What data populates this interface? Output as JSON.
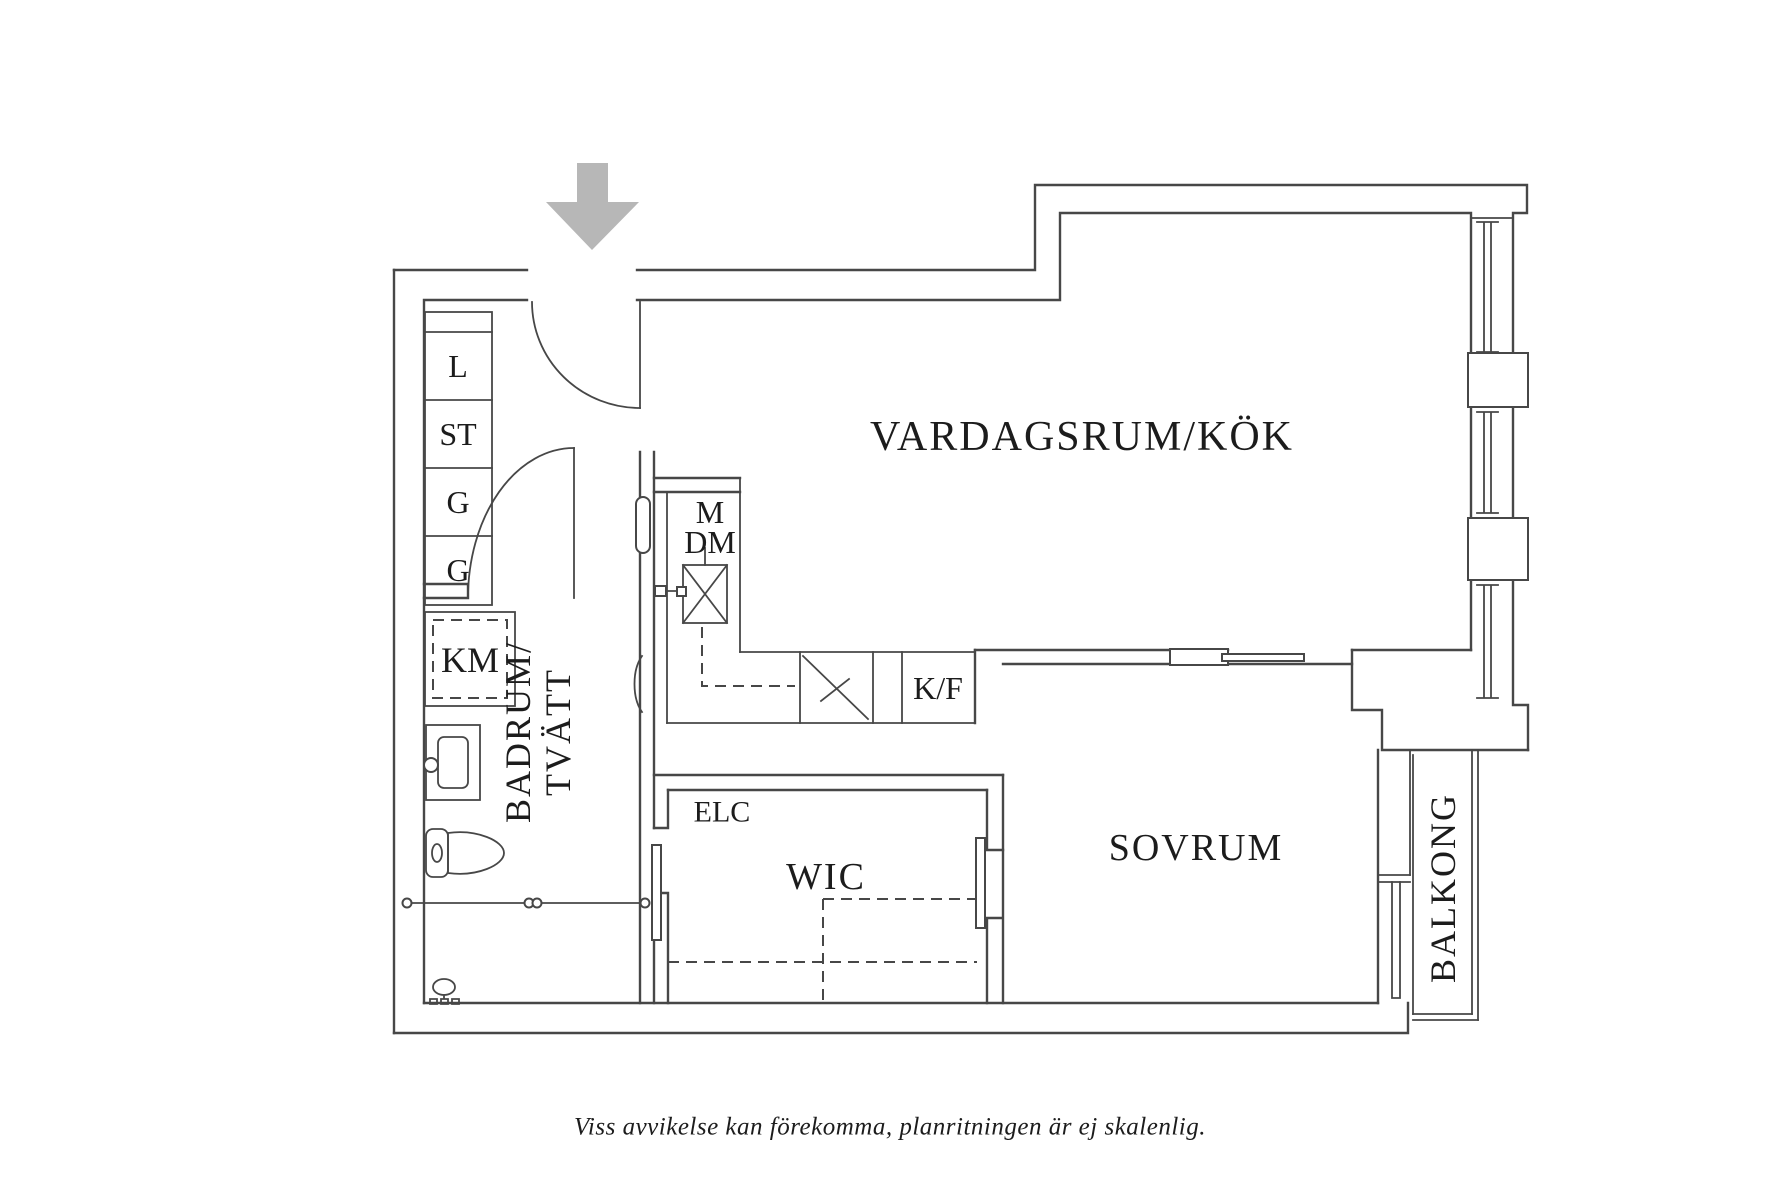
{
  "floorplan": {
    "labels": {
      "living_kitchen": "VARDAGSRUM/KÖK",
      "bedroom": "SOVRUM",
      "bathroom_line1": "BADRUM/",
      "bathroom_line2": "TVÄTT",
      "wic": "WIC",
      "balcony": "BALKONG",
      "electrical": "ELC",
      "closet_1": "L",
      "closet_2": "ST",
      "closet_3": "G",
      "closet_4": "G",
      "washing_machine": "KM",
      "microwave": "M",
      "dishwasher": "DM",
      "fridge_freezer": "K/F"
    },
    "disclaimer": "Viss avvikelse kan förekomma, planritningen är ej skalenlig.",
    "colors": {
      "line": "#474747",
      "text": "#1c1c1c",
      "arrow": "#b7b7b7",
      "background": "#ffffff"
    }
  }
}
